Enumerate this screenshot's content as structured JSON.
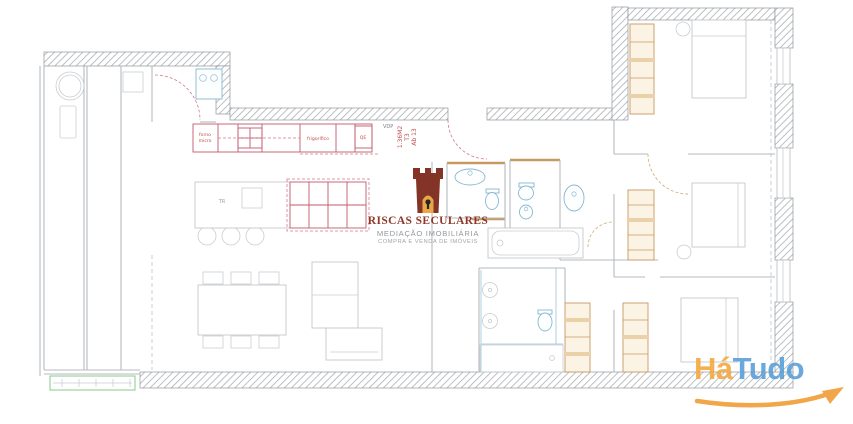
{
  "watermark": {
    "icon": "castle-tower",
    "title": "RISCAS SECULARES",
    "subtitle": "MEDIAÇÃO IMOBILIÁRIA",
    "tagline": "COMPRA E VENDA DE IMÓVEIS",
    "title_color": "#8a2e1d",
    "subtitle_color": "#8d9399"
  },
  "portal_logo": {
    "word_part1": "Há",
    "word_part2": "Tudo",
    "part1_color": "#f5a83f",
    "part2_color": "#5b9fd8",
    "swoosh_color": "#f09e36"
  },
  "plan": {
    "labels": {
      "door_tag": "VDP",
      "unit_line1": "Ab 13",
      "unit_line2": "T3",
      "unit_line3": "1.36M2",
      "oven_line1": "forno",
      "oven_line2": "micro",
      "fridge": "frigorífico",
      "electrical_panel": "QE",
      "island_tag": "TR"
    },
    "colors": {
      "wall_hatch": "#9aa0a6",
      "interior_line": "#b6bbc0",
      "furniture_line": "#c9cdd0",
      "kitchen_red": "#c4586c",
      "fixture_blue": "#87b7d3",
      "wardrobe_tan": "#c79a62",
      "planter_green": "#8bc98b",
      "label_red": "#c0504d"
    }
  }
}
